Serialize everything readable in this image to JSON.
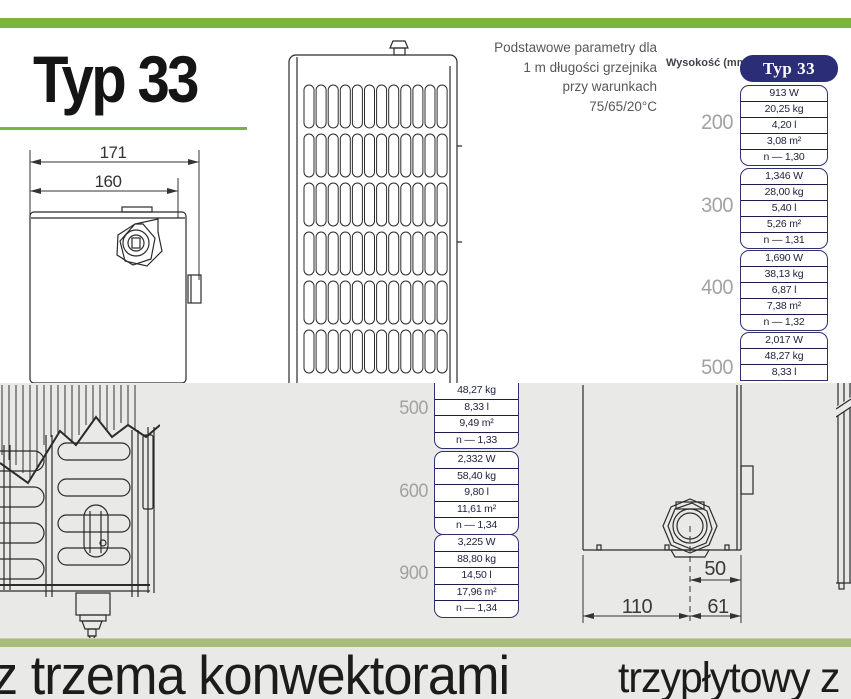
{
  "colors": {
    "green": "#7cb53e",
    "green_muted": "#a9bc7e",
    "navy": "#2b2e76",
    "bottom_bg": "#e9e9e7"
  },
  "top": {
    "title": "Typ 33",
    "params": {
      "line1": "Podstawowe parametry dla",
      "line2": "1 m długości grzejnika",
      "line3": "przy warunkach",
      "line4": "75/65/20°C"
    },
    "drawing_top_view": {
      "dim_outer": "171",
      "dim_inner": "160"
    },
    "table": {
      "height_header": "Wysokość (mm)",
      "type_header": "Typ 33",
      "groups": [
        {
          "height": "200",
          "rows": [
            "913 W",
            "20,25 kg",
            "4,20 l",
            "3,08 m²",
            "n — 1,30"
          ]
        },
        {
          "height": "300",
          "rows": [
            "1,346 W",
            "28,00 kg",
            "5,40 l",
            "5,26 m²",
            "n — 1,31"
          ]
        },
        {
          "height": "400",
          "rows": [
            "1,690 W",
            "38,13 kg",
            "6,87 l",
            "7,38 m²",
            "n — 1,32"
          ]
        },
        {
          "height": "500",
          "rows": [
            "2,017 W",
            "48,27 kg",
            "8,33 l"
          ]
        }
      ]
    }
  },
  "bottom": {
    "table": {
      "groups": [
        {
          "height": "500",
          "rows": [
            "48,27 kg",
            "8,33 l",
            "9,49 m²",
            "n — 1,33"
          ]
        },
        {
          "height": "600",
          "rows": [
            "2,332 W",
            "58,40 kg",
            "9,80 l",
            "11,61 m²",
            "n — 1,34"
          ]
        },
        {
          "height": "900",
          "rows": [
            "3,225 W",
            "88,80 kg",
            "14,50 l",
            "17,96 m²",
            "n — 1,34"
          ]
        }
      ]
    },
    "drawing_bottom_view": {
      "dim_offset": "50",
      "dim_left": "110",
      "dim_right": "61"
    },
    "caption_left": "z trzema konwektorami",
    "caption_right": "trzypłytowy z"
  }
}
